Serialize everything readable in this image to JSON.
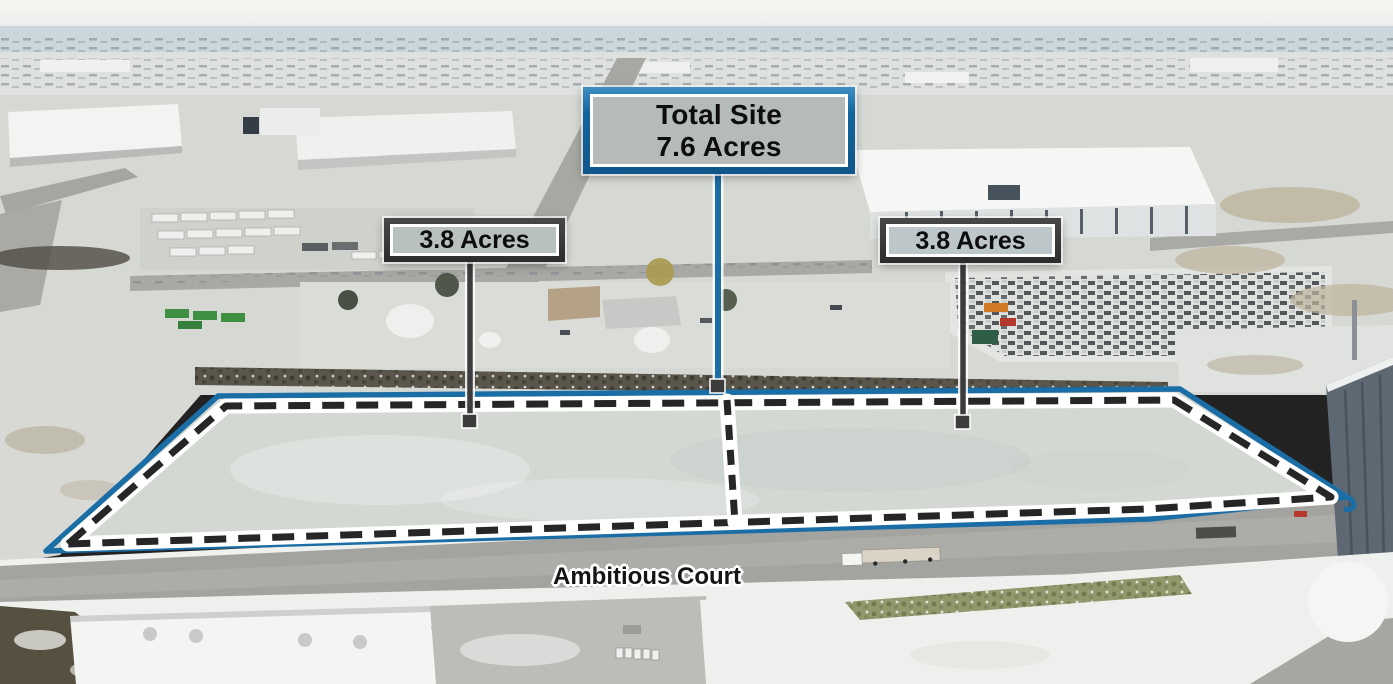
{
  "annotations": {
    "total_site": {
      "title": "Total Site",
      "acreage": "7.6 Acres"
    },
    "parcel_left": {
      "acreage": "3.8 Acres"
    },
    "parcel_right": {
      "acreage": "3.8 Acres"
    },
    "street_name": "Ambitious Court"
  },
  "colors": {
    "boundary_blue": "#1b6da6",
    "dash_black": "#262626",
    "leader_dark": "#3c3c3c",
    "casing_white": "#ffffff",
    "panel_gray": "#b7bfbb",
    "frame_dark": "#313131"
  }
}
